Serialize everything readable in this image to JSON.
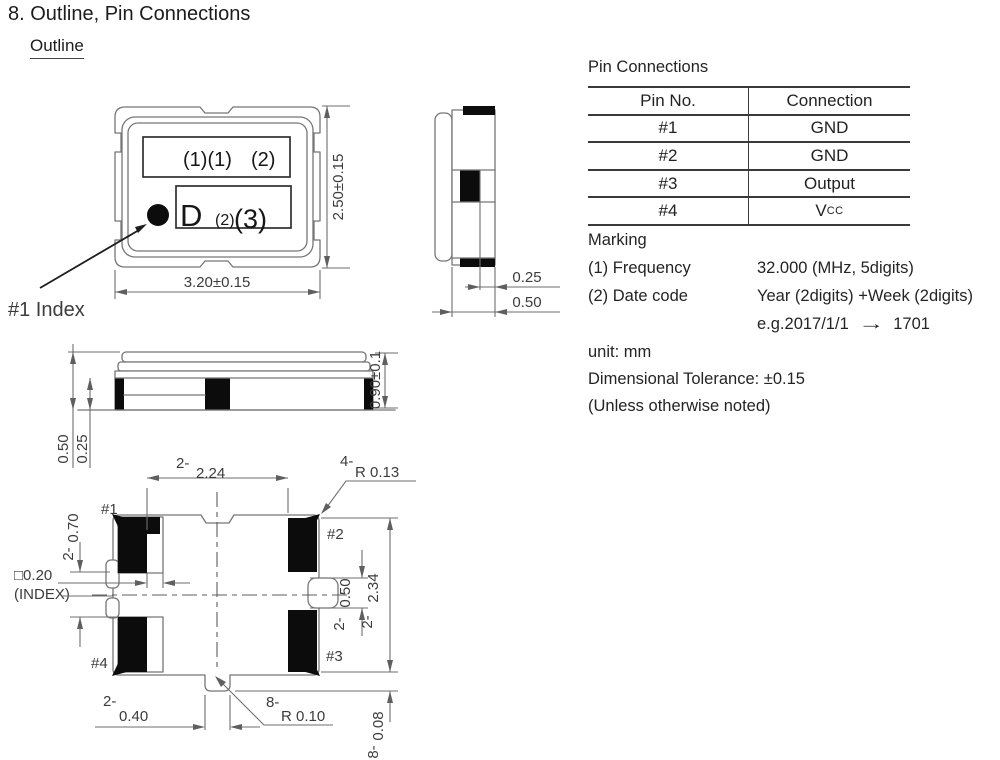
{
  "page": {
    "title": "8. Outline, Pin Connections",
    "section": "Outline"
  },
  "pin_table": {
    "title": "Pin Connections",
    "col_pin": "Pin No.",
    "col_conn": "Connection",
    "rows": [
      {
        "pin": "#1",
        "conn": "GND"
      },
      {
        "pin": "#2",
        "conn": "GND"
      },
      {
        "pin": "#3",
        "conn": "Output"
      },
      {
        "pin": "#4",
        "conn": "Vcc"
      }
    ],
    "vcc_base": "V",
    "vcc_sub": "CC"
  },
  "marking": {
    "title": "Marking",
    "freq_label": "(1) Frequency",
    "freq_value": "32.000 (MHz, 5digits)",
    "date_label": "(2) Date code",
    "date_value": "Year (2digits) +Week (2digits)",
    "example": "e.g.2017/1/1",
    "example_arrow": "→",
    "example_result": "1701"
  },
  "notes": {
    "unit": "unit: mm",
    "tolerance": "Dimensional Tolerance: ±0.15",
    "note": "(Unless otherwise noted)"
  },
  "top_view": {
    "mark_row1_a": "(1)(1)",
    "mark_row1_b": "(2)",
    "mark_row2_a": "D",
    "mark_row2_b": "(2)",
    "mark_row2_c": "(3)",
    "dim_width": "3.20±0.15",
    "dim_height": "2.50±0.15",
    "index_label": "#1 Index"
  },
  "side_view": {
    "dim_a": "0.25",
    "dim_b": "0.50"
  },
  "front_view": {
    "dim_a": "0.50",
    "dim_b": "0.25",
    "dim_height": "0.90±0.1"
  },
  "bottom_view": {
    "pad1": "#1",
    "pad2": "#2",
    "pad3": "#3",
    "pad4": "#4",
    "pitch_x_prefix": "2-",
    "pitch_x": "2.24",
    "corner_r_prefix": "4-",
    "corner_r": "R 0.13",
    "pad_w_prefix": "2-",
    "pad_w": "0.70",
    "index_size": "□0.20",
    "index_label": "(INDEX)",
    "notch_prefix": "2-",
    "notch": "0.50",
    "pitch_y_prefix": "2-",
    "pitch_y": "2.34",
    "tab_prefix": "2-",
    "tab": "0.40",
    "tab_r_prefix": "8-",
    "tab_r": "R 0.10",
    "offset_prefix": "8-",
    "offset": "0.08"
  }
}
